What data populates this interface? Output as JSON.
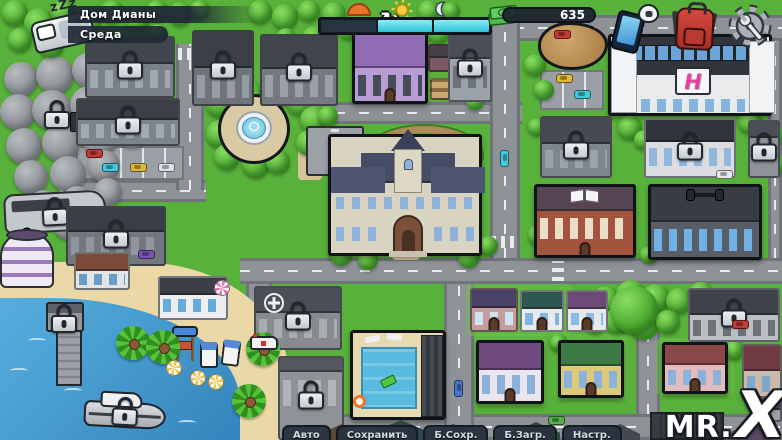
{
  "hud": {
    "sleep_label": "zZz",
    "location": "Дом Дианы",
    "day": "Среда",
    "money": "635",
    "time_segments": [
      "past",
      "future",
      "future"
    ]
  },
  "bottom_tabs": [
    {
      "name": "auto",
      "label": "Авто"
    },
    {
      "name": "save",
      "label": "Сохранить"
    },
    {
      "name": "quick-save",
      "label": "Б.Сохр."
    },
    {
      "name": "quick-load",
      "label": "Б.Загр."
    },
    {
      "name": "settings",
      "label": "Настр."
    }
  ],
  "watermark": {
    "prefix": "MR.",
    "x": "X"
  },
  "map": {
    "mall_logo": "H",
    "refresh_glyph": "↻",
    "roads": [
      [
        "h",
        490,
        15,
        292,
        26
      ],
      [
        "h",
        335,
        102,
        187,
        22
      ],
      [
        "h",
        240,
        258,
        542,
        26
      ],
      [
        "h",
        60,
        180,
        146,
        22
      ],
      [
        "h",
        290,
        414,
        492,
        26
      ],
      [
        "v",
        490,
        15,
        30,
        243
      ],
      [
        "v",
        444,
        284,
        30,
        156
      ],
      [
        "v",
        176,
        44,
        28,
        146
      ],
      [
        "v",
        636,
        332,
        24,
        82
      ],
      [
        "v",
        768,
        41,
        14,
        217
      ],
      [
        "v",
        246,
        284,
        26,
        38
      ]
    ],
    "crosswalks": [
      [
        178,
        48,
        24,
        12,
        "h"
      ],
      [
        492,
        236,
        26,
        12,
        "h"
      ],
      [
        552,
        261,
        12,
        20,
        "v"
      ],
      [
        628,
        17,
        12,
        22,
        "v"
      ]
    ],
    "paths": [
      [
        392,
        250,
        28,
        10
      ],
      [
        298,
        148,
        24,
        32
      ],
      [
        378,
        96,
        16,
        8
      ]
    ],
    "yards": [
      [
        474,
        334,
        72,
        72
      ],
      [
        554,
        334,
        74,
        66
      ],
      [
        656,
        338,
        78,
        58
      ],
      [
        466,
        284,
        106,
        52
      ]
    ],
    "sand": [
      0,
      262,
      288,
      178
    ],
    "water_area": [
      0,
      298,
      240,
      142
    ],
    "waves": [
      [
        28,
        338
      ],
      [
        64,
        388
      ],
      [
        130,
        408
      ],
      [
        178,
        420
      ],
      [
        10,
        368
      ]
    ],
    "trees": [
      [
        2,
        0,
        26
      ],
      [
        24,
        8,
        30
      ],
      [
        50,
        0,
        24
      ],
      [
        74,
        6,
        28
      ],
      [
        100,
        0,
        24
      ],
      [
        124,
        6,
        26
      ],
      [
        146,
        0,
        22
      ],
      [
        8,
        28,
        24
      ],
      [
        38,
        32,
        26
      ],
      [
        148,
        24,
        20
      ],
      [
        168,
        2,
        24
      ],
      [
        190,
        0,
        20
      ],
      [
        248,
        0,
        24
      ],
      [
        272,
        4,
        26
      ],
      [
        298,
        0,
        22
      ],
      [
        322,
        2,
        24
      ],
      [
        338,
        20,
        20
      ],
      [
        302,
        26,
        24
      ],
      [
        276,
        28,
        20
      ],
      [
        418,
        0,
        22
      ],
      [
        428,
        22,
        22
      ],
      [
        442,
        2,
        18
      ],
      [
        524,
        54,
        22
      ],
      [
        534,
        80,
        20
      ],
      [
        466,
        92,
        18
      ],
      [
        206,
        88,
        30
      ],
      [
        232,
        80,
        32
      ],
      [
        260,
        78,
        30
      ],
      [
        286,
        86,
        30
      ],
      [
        300,
        106,
        28
      ],
      [
        296,
        130,
        26
      ],
      [
        206,
        120,
        28
      ],
      [
        214,
        144,
        26
      ],
      [
        242,
        150,
        28
      ],
      [
        266,
        150,
        24
      ],
      [
        318,
        106,
        20
      ],
      [
        330,
        244,
        22
      ],
      [
        358,
        250,
        20
      ],
      [
        458,
        246,
        22
      ],
      [
        478,
        236,
        20
      ],
      [
        528,
        224,
        22
      ],
      [
        618,
        116,
        24
      ],
      [
        634,
        130,
        20
      ],
      [
        738,
        110,
        24
      ],
      [
        762,
        124,
        22
      ],
      [
        766,
        154,
        20
      ],
      [
        640,
        246,
        18
      ],
      [
        528,
        118,
        18
      ],
      [
        592,
        286,
        28
      ],
      [
        616,
        280,
        30
      ],
      [
        642,
        284,
        28
      ],
      [
        666,
        288,
        26
      ],
      [
        688,
        282,
        26
      ],
      [
        604,
        308,
        26
      ],
      [
        630,
        312,
        28
      ],
      [
        656,
        310,
        24
      ],
      [
        584,
        312,
        22
      ],
      [
        700,
        304,
        22
      ],
      [
        550,
        334,
        18
      ],
      [
        724,
        340,
        20
      ]
    ],
    "gray_trees": [
      [
        4,
        62,
        34
      ],
      [
        36,
        56,
        38
      ],
      [
        72,
        52,
        36
      ],
      [
        106,
        60,
        34
      ],
      [
        130,
        74,
        32
      ],
      [
        0,
        94,
        36
      ],
      [
        32,
        90,
        40
      ],
      [
        70,
        86,
        38
      ],
      [
        104,
        92,
        34
      ],
      [
        6,
        128,
        36
      ],
      [
        42,
        124,
        38
      ],
      [
        82,
        120,
        36
      ],
      [
        116,
        116,
        32
      ],
      [
        14,
        160,
        34
      ],
      [
        50,
        156,
        36
      ],
      [
        88,
        150,
        32
      ],
      [
        28,
        190,
        32
      ],
      [
        62,
        186,
        30
      ],
      [
        94,
        178,
        28
      ],
      [
        54,
        212,
        28
      ],
      [
        88,
        206,
        26
      ]
    ],
    "palms": [
      [
        116,
        326
      ],
      [
        146,
        330
      ],
      [
        246,
        332
      ],
      [
        232,
        384
      ]
    ],
    "umbrellas": [
      [
        166,
        360,
        "#f2c84a"
      ],
      [
        190,
        370,
        "#f2c84a"
      ],
      [
        208,
        374,
        "#f2c84a"
      ],
      [
        214,
        280,
        "#e878b0"
      ]
    ],
    "buildings": [
      {
        "id": "parking-northeast",
        "kind": "lot",
        "x": 540,
        "y": 70,
        "w": 64,
        "h": 40
      },
      {
        "id": "parking-store",
        "kind": "lot",
        "x": 76,
        "y": 146,
        "w": 108,
        "h": 34
      },
      {
        "id": "garden-beds",
        "kind": "garden",
        "x": 430,
        "y": 78,
        "w": 32,
        "h": 22
      },
      {
        "id": "store-sign",
        "kind": "sign",
        "x": 70,
        "y": 112,
        "w": 16,
        "h": 30
      },
      {
        "id": "running-track",
        "kind": "track",
        "x": 366,
        "y": 126,
        "w": 116,
        "h": 58
      },
      {
        "id": "basketball-court",
        "kind": "court",
        "x": 306,
        "y": 126,
        "w": 58,
        "h": 50
      },
      {
        "id": "park-fountain",
        "kind": "fountain",
        "x": 204,
        "y": 92,
        "w": 100,
        "h": 74,
        "outlined": true
      },
      {
        "id": "cliff-lookout",
        "kind": "cliff",
        "x": 538,
        "y": 22,
        "w": 70,
        "h": 48,
        "outlined": true
      },
      {
        "id": "factory",
        "kind": "plain",
        "x": 85,
        "y": 36,
        "w": 90,
        "h": 62,
        "roof": "#41464e",
        "wall": "#7a8087",
        "win": "#a0a7ae",
        "rh": 0.45,
        "locked": true
      },
      {
        "id": "house-locked-a",
        "kind": "plain",
        "x": 192,
        "y": 30,
        "w": 62,
        "h": 76,
        "roof": "#3c4046",
        "wall": "#6f747a",
        "win": "#969ca3",
        "rh": 0.5,
        "locked": true
      },
      {
        "id": "house-locked-b",
        "kind": "plain",
        "x": 260,
        "y": 34,
        "w": 78,
        "h": 72,
        "roof": "#42464c",
        "wall": "#757a80",
        "win": "#9aa0a7",
        "rh": 0.48,
        "locked": true
      },
      {
        "id": "farm-house",
        "kind": "plain",
        "x": 352,
        "y": 32,
        "w": 76,
        "h": 72,
        "roof": "#8f6cb4",
        "wall": "#b79cd6",
        "win": "#454c58",
        "rh": 0.5,
        "outlined": true,
        "door": true,
        "deco": "refresh"
      },
      {
        "id": "barn-shed",
        "kind": "plain",
        "x": 428,
        "y": 44,
        "w": 22,
        "h": 28,
        "roof": "#474048",
        "wall": "#7c5862",
        "rh": 0.5
      },
      {
        "id": "church",
        "kind": "plain",
        "x": 448,
        "y": 30,
        "w": 44,
        "h": 72,
        "roof": "#4a4f57",
        "wall": "#9ca2a9",
        "win": "#6d737a",
        "rh": 0.4,
        "locked": true
      },
      {
        "id": "mall",
        "kind": "mall",
        "x": 608,
        "y": 34,
        "w": 164,
        "h": 82,
        "outlined": true
      },
      {
        "id": "store",
        "kind": "plain",
        "x": 76,
        "y": 98,
        "w": 104,
        "h": 48,
        "roof": "#3c4046",
        "wall": "#7e848b",
        "win": "#a2a9b0",
        "rh": 0.45,
        "locked": true
      },
      {
        "id": "camper-van",
        "kind": "rv",
        "x": 4,
        "y": 188,
        "w": 104,
        "h": 50,
        "locked": true
      },
      {
        "id": "modern-house",
        "kind": "plain",
        "x": 66,
        "y": 206,
        "w": 100,
        "h": 60,
        "roof": "#3a3e44",
        "wall": "#73787e",
        "win": "#8f969d",
        "rh": 0.42,
        "locked": true
      },
      {
        "id": "round-tower-house",
        "kind": "round",
        "x": 0,
        "y": 232,
        "w": 54,
        "h": 56
      },
      {
        "id": "brown-roof-house",
        "kind": "plain",
        "x": 74,
        "y": 252,
        "w": 56,
        "h": 38,
        "roof": "#7b4a38",
        "wall": "#e2e4e6",
        "win": "#6a9cc8",
        "rh": 0.5
      },
      {
        "id": "beach-cafe",
        "kind": "plain",
        "x": 158,
        "y": 276,
        "w": 70,
        "h": 44,
        "roof": "#3a3f45",
        "wall": "#edeef0",
        "win": "#64aada",
        "rh": 0.42
      },
      {
        "id": "gray-house",
        "kind": "plain",
        "x": 540,
        "y": 116,
        "w": 72,
        "h": 62,
        "roof": "#464b52",
        "wall": "#80868d",
        "win": "#9ba2aa",
        "rh": 0.45,
        "locked": true
      },
      {
        "id": "showroom",
        "kind": "plain",
        "x": 644,
        "y": 118,
        "w": 92,
        "h": 60,
        "roof": "#30353c",
        "wall": "#dbdde0",
        "win": "#91b8da",
        "rh": 0.4,
        "locked": true
      },
      {
        "id": "workshop",
        "kind": "plain",
        "x": 748,
        "y": 120,
        "w": 32,
        "h": 58,
        "roof": "#4a4f56",
        "wall": "#8d9399",
        "win": "#aaafb4",
        "rh": 0.3,
        "locked": true
      },
      {
        "id": "library",
        "kind": "plain",
        "x": 534,
        "y": 184,
        "w": 102,
        "h": 74,
        "roof": "#574452",
        "wall": "#a2543f",
        "win": "#e9dfc8",
        "rh": 0.35,
        "outlined": true,
        "deco": "book",
        "door": true
      },
      {
        "id": "gym",
        "kind": "plain",
        "x": 648,
        "y": 184,
        "w": 114,
        "h": 76,
        "roof": "#383d44",
        "wall": "#585e66",
        "win": "#72b2e2",
        "rh": 0.5,
        "outlined": true,
        "deco": "dumbbell"
      },
      {
        "id": "school",
        "kind": "school",
        "x": 328,
        "y": 134,
        "w": 154,
        "h": 122,
        "outlined": true
      },
      {
        "id": "hospital",
        "kind": "plain",
        "x": 254,
        "y": 286,
        "w": 88,
        "h": 64,
        "roof": "#4b5056",
        "wall": "#878b90",
        "win": "#a8adb2",
        "rh": 0.42,
        "locked": true,
        "deco": "cross"
      },
      {
        "id": "ambulance",
        "kind": "ambulance",
        "x": 250,
        "y": 334,
        "w": 30,
        "h": 18
      },
      {
        "id": "apartment-block",
        "kind": "plain",
        "x": 278,
        "y": 356,
        "w": 66,
        "h": 84,
        "roof": "#55595f",
        "wall": "#8f9398",
        "win": "#b0b4b8",
        "rh": 0.18,
        "locked": true
      },
      {
        "id": "pool-area",
        "kind": "pool",
        "x": 350,
        "y": 330,
        "w": 96,
        "h": 90,
        "outlined": true
      },
      {
        "id": "pier",
        "kind": "pier",
        "x": 46,
        "y": 302,
        "w": 60,
        "h": 84,
        "locked": true
      },
      {
        "id": "lifeguard-tower",
        "kind": "lifeguard",
        "x": 172,
        "y": 326,
        "w": 26,
        "h": 38
      },
      {
        "id": "beach-cabins",
        "kind": "cabins",
        "x": 200,
        "y": 340,
        "w": 42,
        "h": 30
      },
      {
        "id": "yacht",
        "kind": "boat",
        "x": 84,
        "y": 390,
        "w": 84,
        "h": 42,
        "locked": true
      },
      {
        "id": "cottage-pink",
        "kind": "plain",
        "x": 470,
        "y": 288,
        "w": 48,
        "h": 44,
        "roof": "#4b4367",
        "wall": "#c79c9c",
        "win": "#cfe2f2",
        "rh": 0.45,
        "door": true
      },
      {
        "id": "cottage-teal-roof",
        "kind": "plain",
        "x": 520,
        "y": 290,
        "w": 44,
        "h": 42,
        "roof": "#2e5752",
        "wall": "#e8eaec",
        "win": "#82b4e2",
        "rh": 0.45,
        "door": true
      },
      {
        "id": "cottage-purple-roof",
        "kind": "plain",
        "x": 566,
        "y": 290,
        "w": 42,
        "h": 42,
        "roof": "#6b4a78",
        "wall": "#e6e8ea",
        "win": "#8cbae6",
        "rh": 0.45,
        "door": true
      },
      {
        "id": "tree-house",
        "kind": "treehouse",
        "x": 616,
        "y": 294,
        "w": 38,
        "h": 40,
        "outlined": true
      },
      {
        "id": "gray-mansion",
        "kind": "plain",
        "x": 688,
        "y": 288,
        "w": 92,
        "h": 54,
        "roof": "#3f444b",
        "wall": "#bbbfc4",
        "win": "#6c7278",
        "rh": 0.5,
        "locked": true
      },
      {
        "id": "purple-house",
        "kind": "plain",
        "x": 476,
        "y": 340,
        "w": 68,
        "h": 64,
        "roof": "#6e4a80",
        "wall": "#e9e5ee",
        "win": "#8cb2da",
        "rh": 0.46,
        "outlined": true,
        "door": true
      },
      {
        "id": "yellow-house",
        "kind": "plain",
        "x": 558,
        "y": 340,
        "w": 66,
        "h": 58,
        "roof": "#3e7a46",
        "wall": "#dcc97a",
        "win": "#8cb2da",
        "rh": 0.44,
        "outlined": true,
        "door": true
      },
      {
        "id": "pink-house",
        "kind": "plain",
        "x": 662,
        "y": 342,
        "w": 66,
        "h": 52,
        "roof": "#8a4848",
        "wall": "#e3bcbc",
        "win": "#8cb2da",
        "rh": 0.44,
        "outlined": true,
        "door": true
      },
      {
        "id": "maroon-house",
        "kind": "plain",
        "x": 742,
        "y": 344,
        "w": 40,
        "h": 54,
        "roof": "#6e3a44",
        "wall": "#c9b9a9",
        "win": "#7fa8cc",
        "rh": 0.5
      },
      {
        "id": "beach-shed",
        "kind": "plain",
        "x": 754,
        "y": 398,
        "w": 28,
        "h": 24,
        "roof": "#4a4e54",
        "wall": "#9ba1a6",
        "rh": 0.5
      },
      {
        "id": "forest-lock",
        "kind": "lockonly",
        "x": 44,
        "y": 100
      },
      {
        "id": "roof-row-a",
        "kind": "gable",
        "x": 320,
        "y": 424,
        "w": 44,
        "h": 22,
        "roof": "#5a4636"
      },
      {
        "id": "roof-row-b",
        "kind": "gable",
        "x": 374,
        "y": 420,
        "w": 54,
        "h": 26,
        "roof": "#2e4648"
      },
      {
        "id": "roof-row-c",
        "kind": "gable",
        "x": 430,
        "y": 424,
        "w": 46,
        "h": 22,
        "roof": "#3a3f46"
      },
      {
        "id": "roof-row-d",
        "kind": "gable",
        "x": 512,
        "y": 422,
        "w": 48,
        "h": 24,
        "roof": "#2f4a40"
      },
      {
        "id": "roof-row-e",
        "kind": "gable",
        "x": 600,
        "y": 424,
        "w": 40,
        "h": 22,
        "roof": "#44484f"
      },
      {
        "id": "warehouse",
        "kind": "warehouse",
        "x": 650,
        "y": 412,
        "w": 74,
        "h": 28
      },
      {
        "id": "roof-row-f",
        "kind": "gable",
        "x": 728,
        "y": 424,
        "w": 44,
        "h": 20,
        "roof": "#5d4a66"
      }
    ],
    "cars": [
      [
        86,
        149,
        "#c23b34",
        0
      ],
      [
        102,
        163,
        "#45c8dc",
        0
      ],
      [
        130,
        163,
        "#e0b83c",
        0
      ],
      [
        158,
        163,
        "#dfe2e5",
        0
      ],
      [
        556,
        74,
        "#e0b83c",
        0
      ],
      [
        574,
        90,
        "#45c8dc",
        0
      ],
      [
        554,
        30,
        "#c23b34",
        0
      ],
      [
        716,
        170,
        "#e8eaec",
        0
      ],
      [
        138,
        250,
        "#7a55b0",
        0
      ],
      [
        732,
        320,
        "#c23b34",
        0
      ],
      [
        548,
        416,
        "#55b04a",
        0
      ],
      [
        450,
        384,
        "#4a78c8",
        90
      ],
      [
        496,
        154,
        "#45c8dc",
        90
      ]
    ]
  }
}
